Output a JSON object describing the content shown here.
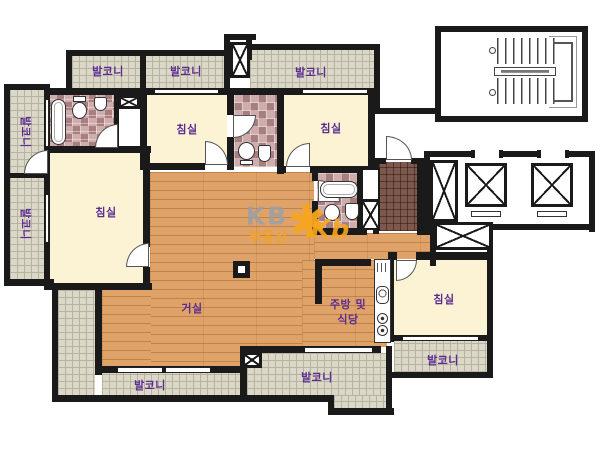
{
  "rooms": {
    "balcony": "발코니",
    "bedroom": "침실",
    "living_room": "거실",
    "kitchen_dining_line1": "주방 및",
    "kitchen_dining_line2": "식당"
  },
  "watermark": {
    "brand": "KB",
    "brand_sub": "부동산",
    "logo_star": "✱",
    "logo_letters": "Kb"
  },
  "colors": {
    "label_purple": "#5b2d8f",
    "wall_black": "#1a1a1a",
    "wood_floor": "#dfa269",
    "room_cream": "#fbf3d4",
    "balcony_tile": "#dcd8c8",
    "bath_tile": "#cfadad",
    "entry_tile": "#7d584c",
    "watermark_gray": "#9aa0a8",
    "watermark_orange": "#f7a61f"
  }
}
